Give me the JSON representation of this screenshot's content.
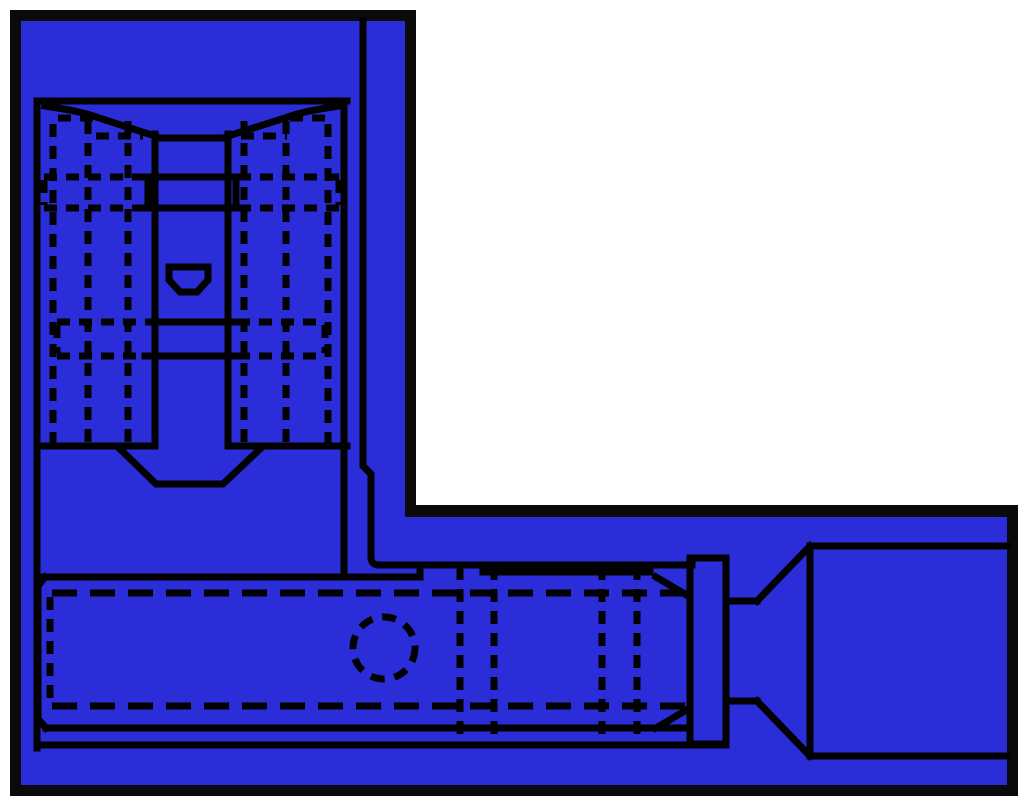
{
  "canvas": {
    "width": 1024,
    "height": 804
  },
  "colors": {
    "page_background": "#ffffff",
    "window_border": "#0a0a0a",
    "window_fill": "#2b2dd8",
    "line": "#010101"
  },
  "window_shape": {
    "outer_l_path": "M10,10 H416 V505 H1018 V796 H10 Z",
    "inner_l_path": "M21,21 H405 V517 H1007 V785 H21 Z"
  },
  "diagram": {
    "default_stroke_width": 7,
    "top_view": {
      "elements": [
        {
          "name": "frame-top-line",
          "type": "path",
          "d": "M37,101 H347"
        },
        {
          "name": "frame-right-line",
          "type": "path",
          "d": "M344,101 V577"
        },
        {
          "name": "frame-left-line",
          "type": "path",
          "d": "M37,101 V748"
        },
        {
          "name": "frame-bottom-left-line",
          "type": "path",
          "d": "M37,446 H155"
        },
        {
          "name": "frame-bottom-right-line",
          "type": "path",
          "d": "M228,446 H347"
        },
        {
          "name": "slot-left-line",
          "type": "path",
          "d": "M155,134 V446"
        },
        {
          "name": "slot-right-line",
          "type": "path",
          "d": "M228,134 V446"
        },
        {
          "name": "shoulder-left-line",
          "type": "path",
          "d": "M45,106 C72,110 86,113 99,118 L155,136"
        },
        {
          "name": "shoulder-right-line",
          "type": "path",
          "d": "M339,106 C312,110 298,113 285,118 L228,136"
        },
        {
          "name": "slot-cross-top-line",
          "type": "path",
          "d": "M155,138 H228"
        },
        {
          "name": "stop-box-outline",
          "type": "path",
          "d": "M148,177 H236 M148,208 H236 M148,177 V208 M236,177 V208"
        },
        {
          "name": "slot-cross-lower-line-1",
          "type": "path",
          "d": "M149,322 H234"
        },
        {
          "name": "slot-cross-lower-line-2",
          "type": "path",
          "d": "M145,356 H239"
        },
        {
          "name": "dimple-outline",
          "type": "path",
          "d": "M169,267 H208 V280 L197,292 H180 L169,280 Z"
        },
        {
          "name": "taper-notch-outline",
          "type": "path",
          "d": "M118,447 L156,484 H223 L261,448"
        },
        {
          "name": "hidden-vertical-1",
          "type": "path",
          "d": "M53,124 V443",
          "dash": "13 9"
        },
        {
          "name": "hidden-vertical-2",
          "type": "path",
          "d": "M88,121 V443",
          "dash": "13 9"
        },
        {
          "name": "hidden-vertical-3",
          "type": "path",
          "d": "M128,121 V443",
          "dash": "13 9"
        },
        {
          "name": "hidden-vertical-4",
          "type": "path",
          "d": "M244,121 V443",
          "dash": "13 9"
        },
        {
          "name": "hidden-vertical-5",
          "type": "path",
          "d": "M286,121 V443",
          "dash": "13 9"
        },
        {
          "name": "hidden-vertical-6",
          "type": "path",
          "d": "M328,124 V443",
          "dash": "13 9"
        },
        {
          "name": "hidden-top-left",
          "type": "path",
          "d": "M58,118 H94",
          "dash": "13 9"
        },
        {
          "name": "hidden-top-right",
          "type": "path",
          "d": "M290,118 H326",
          "dash": "13 9"
        },
        {
          "name": "hidden-shoulder-left",
          "type": "path",
          "d": "M96,136 H143",
          "dash": "13 9"
        },
        {
          "name": "hidden-shoulder-right",
          "type": "path",
          "d": "M241,136 H287",
          "dash": "13 9"
        },
        {
          "name": "hidden-wing-top-left",
          "type": "path",
          "d": "M44,177 H146 M44,208 H146 M44,180 V205",
          "dash": "13 9"
        },
        {
          "name": "hidden-wing-top-right",
          "type": "path",
          "d": "M238,177 H339 M238,208 H339 M339,180 V205",
          "dash": "13 9"
        },
        {
          "name": "hidden-wing-bottom-left",
          "type": "path",
          "d": "M57,322 H147 M57,356 H147 M57,325 V353",
          "dash": "13 9"
        },
        {
          "name": "hidden-wing-bottom-right",
          "type": "path",
          "d": "M237,322 H325 M237,356 H325 M325,325 V353",
          "dash": "13 9"
        }
      ]
    },
    "side_view": {
      "elements": [
        {
          "name": "sheet-right-and-barrel-top-line",
          "type": "path",
          "d": "M363,21 V466 L371,474 V557 Q371,565 379,565 H692"
        },
        {
          "name": "blade-top-line",
          "type": "path",
          "d": "M40,577 H420"
        },
        {
          "name": "blade-left-end-line",
          "type": "path",
          "d": "M45,577 L38,586 V719 L46,728"
        },
        {
          "name": "blade-bottom-line",
          "type": "path",
          "d": "M46,728 H690"
        },
        {
          "name": "barrel-step-line",
          "type": "path",
          "d": "M420,577 V565"
        },
        {
          "name": "bottom-outer-line",
          "type": "path",
          "d": "M37,745 H726"
        },
        {
          "name": "barrel-inner-top-line",
          "type": "path",
          "d": "M486,565 V572 M483,572 H650"
        },
        {
          "name": "barrel-chamfer-top-line",
          "type": "path",
          "d": "M656,577 L688,596"
        },
        {
          "name": "barrel-chamfer-bottom-line",
          "type": "path",
          "d": "M656,728 L688,709"
        },
        {
          "name": "flange-outline",
          "type": "path",
          "d": "M690,558 H726 V744 H690 Z"
        },
        {
          "name": "neck-lines",
          "type": "path",
          "d": "M726,601 H757 M726,701 H757"
        },
        {
          "name": "funnel-lines",
          "type": "path",
          "d": "M757,601 L810,546 M757,701 L810,756"
        },
        {
          "name": "insulation-sleeve-outline",
          "type": "path",
          "d": "M810,546 H1007 M810,756 H1007 M810,546 V756"
        },
        {
          "name": "hidden-upper-line",
          "type": "path",
          "d": "M52,593 H688",
          "dash": "25 13"
        },
        {
          "name": "hidden-lower-line",
          "type": "path",
          "d": "M52,706 H688",
          "dash": "25 13"
        },
        {
          "name": "hidden-blade-end-line",
          "type": "path",
          "d": "M50,597 V702",
          "dash": "13 9"
        },
        {
          "name": "inspection-hole-circle",
          "type": "circle",
          "cx": 384,
          "cy": 648,
          "r": 31,
          "dash": "14 10"
        },
        {
          "name": "hidden-crimp-line-1",
          "type": "path",
          "d": "M460,567 V742",
          "dash": "13 9"
        },
        {
          "name": "hidden-crimp-line-2",
          "type": "path",
          "d": "M494,567 V742",
          "dash": "13 9"
        },
        {
          "name": "hidden-crimp-line-3",
          "type": "path",
          "d": "M602,567 V742",
          "dash": "13 9"
        },
        {
          "name": "hidden-crimp-line-4",
          "type": "path",
          "d": "M637,567 V742",
          "dash": "13 9"
        }
      ]
    }
  }
}
